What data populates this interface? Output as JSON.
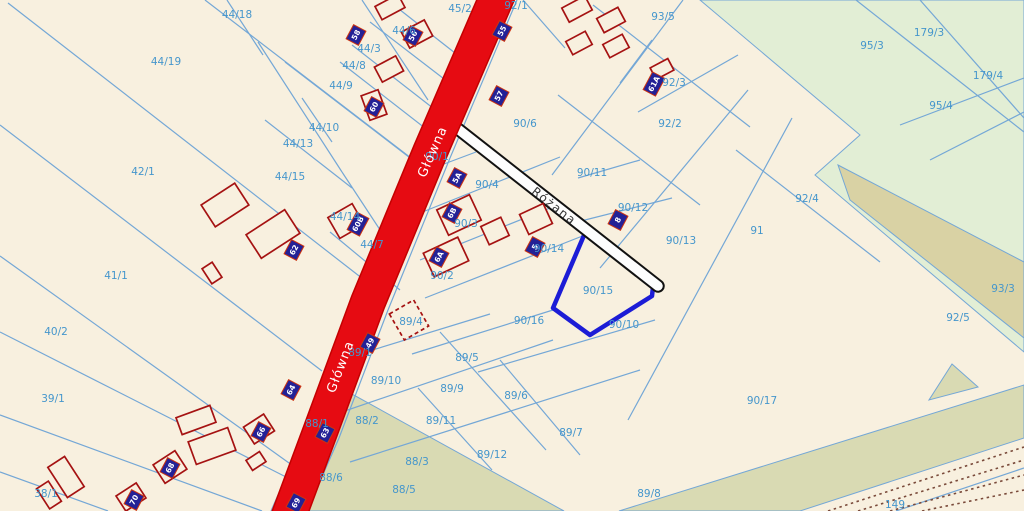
{
  "map": {
    "width": 1024,
    "height": 511,
    "colors": {
      "background": "#f8f0df",
      "boundary_line": "#74a7d6",
      "parcel_label": "#4596cc",
      "road_main_fill": "#e60b12",
      "road_main_casing": "#c40000",
      "road_side_casing": "#111111",
      "road_side_fill": "#fdfdfd",
      "building_outline": "#a51212",
      "plate_fill": "#232196",
      "plate_border": "#cc3311",
      "plate_text": "#ffffff",
      "green_area": "#e2eed5",
      "khaki_area": "#d9d2a4",
      "olive_area": "#d9dab3",
      "highlight_stroke": "#1c1cd6",
      "railway_dots": "#7a4a3a"
    },
    "areas": [
      {
        "name": "forest-green-large",
        "fill": "#e2eed5",
        "points": [
          [
            700,
            0
          ],
          [
            1024,
            0
          ],
          [
            1024,
            352
          ],
          [
            815,
            175
          ],
          [
            860,
            135
          ]
        ]
      },
      {
        "name": "forest-khaki-band",
        "fill": "#d9d2a4",
        "points": [
          [
            838,
            165
          ],
          [
            1024,
            262
          ],
          [
            1024,
            338
          ],
          [
            850,
            200
          ]
        ]
      },
      {
        "name": "olive-left-block",
        "fill": "#d9dab3",
        "points": [
          [
            341,
            388
          ],
          [
            564,
            511
          ],
          [
            300,
            511
          ],
          [
            317,
            430
          ]
        ]
      },
      {
        "name": "olive-bottom-band",
        "fill": "#d9dab3",
        "points": [
          [
            619,
            511
          ],
          [
            1024,
            385
          ],
          [
            1024,
            438
          ],
          [
            800,
            511
          ]
        ]
      },
      {
        "name": "olive-triangle",
        "fill": "#d9dab3",
        "points": [
          [
            952,
            364
          ],
          [
            978,
            387
          ],
          [
            929,
            400
          ]
        ]
      }
    ],
    "boundary_segments": [
      [
        205,
        0,
        424,
        168
      ],
      [
        8,
        3,
        372,
        286
      ],
      [
        0,
        125,
        322,
        371
      ],
      [
        0,
        256,
        296,
        468
      ],
      [
        0,
        332,
        288,
        478
      ],
      [
        0,
        415,
        262,
        511
      ],
      [
        0,
        472,
        108,
        511
      ],
      [
        227,
        0,
        263,
        55
      ],
      [
        258,
        42,
        342,
        172
      ],
      [
        302,
        98,
        332,
        142
      ],
      [
        265,
        120,
        352,
        188
      ],
      [
        285,
        62,
        418,
        164
      ],
      [
        342,
        172,
        388,
        242
      ],
      [
        330,
        232,
        400,
        290
      ],
      [
        362,
        0,
        428,
        100
      ],
      [
        390,
        2,
        455,
        53
      ],
      [
        370,
        22,
        448,
        82
      ],
      [
        352,
        45,
        438,
        112
      ],
      [
        340,
        62,
        430,
        132
      ],
      [
        523,
        0,
        565,
        48
      ],
      [
        593,
        5,
        750,
        127
      ],
      [
        683,
        0,
        552,
        175
      ],
      [
        620,
        83,
        652,
        40
      ],
      [
        638,
        112,
        738,
        55
      ],
      [
        558,
        95,
        700,
        205
      ],
      [
        428,
        170,
        476,
        152
      ],
      [
        420,
        213,
        560,
        157
      ],
      [
        420,
        260,
        560,
        204
      ],
      [
        425,
        298,
        585,
        235
      ],
      [
        412,
        354,
        553,
        310
      ],
      [
        578,
        178,
        640,
        160
      ],
      [
        577,
        222,
        672,
        198
      ],
      [
        748,
        90,
        600,
        268
      ],
      [
        792,
        118,
        628,
        420
      ],
      [
        736,
        150,
        880,
        262
      ],
      [
        478,
        372,
        655,
        320
      ],
      [
        330,
        363,
        490,
        314
      ],
      [
        333,
        415,
        553,
        340
      ],
      [
        350,
        462,
        640,
        370
      ],
      [
        440,
        332,
        546,
        450
      ],
      [
        500,
        360,
        580,
        455
      ],
      [
        418,
        388,
        492,
        470
      ],
      [
        856,
        0,
        1024,
        132
      ],
      [
        920,
        0,
        1024,
        118
      ],
      [
        900,
        125,
        1024,
        78
      ],
      [
        930,
        160,
        1024,
        112
      ],
      [
        896,
        511,
        1024,
        468
      ],
      [
        481,
        0,
        415,
        158
      ],
      [
        415,
        158,
        352,
        310
      ],
      [
        352,
        310,
        303,
        438
      ],
      [
        303,
        438,
        271,
        511
      ],
      [
        517,
        0,
        450,
        158
      ],
      [
        450,
        158,
        388,
        310
      ],
      [
        388,
        310,
        339,
        438
      ],
      [
        339,
        438,
        307,
        511
      ]
    ],
    "railway": {
      "label": "149",
      "dotted_lines": [
        [
          828,
          511,
          1024,
          447
        ],
        [
          858,
          511,
          1024,
          460
        ],
        [
          890,
          511,
          1024,
          475
        ],
        [
          922,
          511,
          1024,
          490
        ]
      ]
    },
    "roads": {
      "glowna": {
        "name": "Główna",
        "centerline": [
          [
            499,
            -8
          ],
          [
            430,
            152
          ],
          [
            368,
            302
          ],
          [
            320,
            432
          ],
          [
            288,
            518
          ]
        ],
        "width": 33,
        "labels": [
          {
            "x": 433,
            "y": 152,
            "rot": -66
          },
          {
            "x": 341,
            "y": 367,
            "rot": -69
          }
        ]
      },
      "rozana": {
        "name": "Różana",
        "centerline": [
          [
            449,
            122
          ],
          [
            658,
            286
          ]
        ],
        "width": 9.5,
        "labels": [
          {
            "x": 554,
            "y": 206,
            "rot": 38
          }
        ]
      }
    },
    "highlighted_parcel": {
      "id": "90/15",
      "points": [
        [
          585,
          233
        ],
        [
          653,
          287
        ],
        [
          652,
          296
        ],
        [
          590,
          335
        ],
        [
          553,
          308
        ]
      ]
    },
    "buildings": [
      {
        "cx": 390,
        "cy": 7,
        "w": 26,
        "h": 15,
        "rot": -28
      },
      {
        "cx": 577,
        "cy": 9,
        "w": 26,
        "h": 16,
        "rot": -28
      },
      {
        "cx": 611,
        "cy": 20,
        "w": 24,
        "h": 16,
        "rot": -28
      },
      {
        "cx": 579,
        "cy": 43,
        "w": 22,
        "h": 15,
        "rot": -28
      },
      {
        "cx": 616,
        "cy": 46,
        "w": 22,
        "h": 15,
        "rot": -28
      },
      {
        "cx": 662,
        "cy": 69,
        "w": 20,
        "h": 13,
        "rot": -28
      },
      {
        "cx": 417,
        "cy": 34,
        "w": 26,
        "h": 18,
        "rot": -28
      },
      {
        "cx": 389,
        "cy": 69,
        "w": 24,
        "h": 17,
        "rot": -28
      },
      {
        "cx": 374,
        "cy": 105,
        "w": 18,
        "h": 26,
        "rot": -20
      },
      {
        "cx": 225,
        "cy": 205,
        "w": 40,
        "h": 26,
        "rot": -33
      },
      {
        "cx": 273,
        "cy": 234,
        "w": 46,
        "h": 28,
        "rot": -33
      },
      {
        "cx": 212,
        "cy": 273,
        "w": 12,
        "h": 18,
        "rot": -33
      },
      {
        "cx": 346,
        "cy": 221,
        "w": 28,
        "h": 24,
        "rot": -30
      },
      {
        "cx": 459,
        "cy": 215,
        "w": 36,
        "h": 28,
        "rot": -25
      },
      {
        "cx": 446,
        "cy": 257,
        "w": 38,
        "h": 26,
        "rot": -25
      },
      {
        "cx": 495,
        "cy": 231,
        "w": 22,
        "h": 20,
        "rot": -25
      },
      {
        "cx": 536,
        "cy": 219,
        "w": 26,
        "h": 22,
        "rot": -25
      },
      {
        "cx": 196,
        "cy": 420,
        "w": 36,
        "h": 18,
        "rot": -20
      },
      {
        "cx": 212,
        "cy": 446,
        "w": 42,
        "h": 24,
        "rot": -20
      },
      {
        "cx": 259,
        "cy": 429,
        "w": 24,
        "h": 20,
        "rot": -33
      },
      {
        "cx": 256,
        "cy": 461,
        "w": 16,
        "h": 12,
        "rot": -33
      },
      {
        "cx": 170,
        "cy": 467,
        "w": 26,
        "h": 22,
        "rot": -33
      },
      {
        "cx": 131,
        "cy": 497,
        "w": 24,
        "h": 18,
        "rot": -33
      },
      {
        "cx": 66,
        "cy": 477,
        "w": 20,
        "h": 36,
        "rot": -33
      },
      {
        "cx": 49,
        "cy": 495,
        "w": 14,
        "h": 24,
        "rot": -33
      },
      {
        "cx": 409,
        "cy": 320,
        "w": 28,
        "h": 30,
        "rot": -30,
        "dashed": true
      }
    ],
    "address_plates": [
      {
        "x": 356,
        "y": 35,
        "num": "58",
        "rot": -62
      },
      {
        "x": 413,
        "y": 36,
        "num": "56",
        "rot": -62
      },
      {
        "x": 502,
        "y": 31,
        "num": "55",
        "rot": -62
      },
      {
        "x": 374,
        "y": 107,
        "num": "60",
        "rot": -62
      },
      {
        "x": 499,
        "y": 96,
        "num": "57",
        "rot": -62
      },
      {
        "x": 654,
        "y": 84,
        "num": "61A",
        "rot": -62
      },
      {
        "x": 457,
        "y": 178,
        "num": "5A",
        "rot": -62
      },
      {
        "x": 358,
        "y": 224,
        "num": "60B",
        "rot": -62
      },
      {
        "x": 294,
        "y": 250,
        "num": "62",
        "rot": -62
      },
      {
        "x": 452,
        "y": 213,
        "num": "6B",
        "rot": -62
      },
      {
        "x": 439,
        "y": 257,
        "num": "6A",
        "rot": -62
      },
      {
        "x": 535,
        "y": 247,
        "num": "5",
        "rot": -62
      },
      {
        "x": 618,
        "y": 220,
        "num": "8",
        "rot": -62
      },
      {
        "x": 291,
        "y": 390,
        "num": "64",
        "rot": -62
      },
      {
        "x": 325,
        "y": 433,
        "num": "63",
        "rot": -62
      },
      {
        "x": 261,
        "y": 432,
        "num": "66",
        "rot": -62
      },
      {
        "x": 370,
        "y": 343,
        "num": "49",
        "rot": -62
      },
      {
        "x": 170,
        "y": 468,
        "num": "68",
        "rot": -62
      },
      {
        "x": 134,
        "y": 500,
        "num": "70",
        "rot": -62
      },
      {
        "x": 296,
        "y": 503,
        "num": "69",
        "rot": -62
      }
    ],
    "parcel_labels": [
      {
        "id": "44/18",
        "x": 237,
        "y": 15
      },
      {
        "id": "45/2",
        "x": 460,
        "y": 9
      },
      {
        "id": "92/1",
        "x": 516,
        "y": 6
      },
      {
        "id": "93/5",
        "x": 663,
        "y": 17
      },
      {
        "id": "179/3",
        "x": 929,
        "y": 33
      },
      {
        "id": "44/19",
        "x": 166,
        "y": 62
      },
      {
        "id": "44/6",
        "x": 404,
        "y": 31
      },
      {
        "id": "44/3",
        "x": 369,
        "y": 49
      },
      {
        "id": "95/3",
        "x": 872,
        "y": 46
      },
      {
        "id": "44/8",
        "x": 354,
        "y": 66
      },
      {
        "id": "44/9",
        "x": 341,
        "y": 86
      },
      {
        "id": "92/3",
        "x": 674,
        "y": 83
      },
      {
        "id": "179/4",
        "x": 988,
        "y": 76
      },
      {
        "id": "44/10",
        "x": 324,
        "y": 128
      },
      {
        "id": "92/2",
        "x": 670,
        "y": 124
      },
      {
        "id": "90/6",
        "x": 525,
        "y": 124
      },
      {
        "id": "95/4",
        "x": 941,
        "y": 106
      },
      {
        "id": "44/13",
        "x": 298,
        "y": 144
      },
      {
        "id": "42/1",
        "x": 143,
        "y": 172
      },
      {
        "id": "44/15",
        "x": 290,
        "y": 177
      },
      {
        "id": "90/1",
        "x": 437,
        "y": 157
      },
      {
        "id": "90/4",
        "x": 487,
        "y": 185
      },
      {
        "id": "90/11",
        "x": 592,
        "y": 173
      },
      {
        "id": "92/4",
        "x": 807,
        "y": 199
      },
      {
        "id": "90/12",
        "x": 633,
        "y": 208
      },
      {
        "id": "44/14",
        "x": 345,
        "y": 217
      },
      {
        "id": "91",
        "x": 757,
        "y": 231
      },
      {
        "id": "90/13",
        "x": 681,
        "y": 241
      },
      {
        "id": "44/7",
        "x": 372,
        "y": 245
      },
      {
        "id": "90/3",
        "x": 466,
        "y": 224
      },
      {
        "id": "90/2",
        "x": 442,
        "y": 276
      },
      {
        "id": "90/14",
        "x": 549,
        "y": 249
      },
      {
        "id": "41/1",
        "x": 116,
        "y": 276
      },
      {
        "id": "90/15",
        "x": 598,
        "y": 291
      },
      {
        "id": "93/3",
        "x": 1003,
        "y": 289
      },
      {
        "id": "92/5",
        "x": 958,
        "y": 318
      },
      {
        "id": "90/16",
        "x": 529,
        "y": 321
      },
      {
        "id": "90/10",
        "x": 624,
        "y": 325
      },
      {
        "id": "40/2",
        "x": 56,
        "y": 332
      },
      {
        "id": "89/4",
        "x": 411,
        "y": 322
      },
      {
        "id": "89/1",
        "x": 360,
        "y": 353
      },
      {
        "id": "89/5",
        "x": 467,
        "y": 358
      },
      {
        "id": "39/1",
        "x": 53,
        "y": 399
      },
      {
        "id": "89/10",
        "x": 386,
        "y": 381
      },
      {
        "id": "89/9",
        "x": 452,
        "y": 389
      },
      {
        "id": "89/6",
        "x": 516,
        "y": 396
      },
      {
        "id": "90/17",
        "x": 762,
        "y": 401
      },
      {
        "id": "88/2",
        "x": 367,
        "y": 421
      },
      {
        "id": "88/1",
        "x": 317,
        "y": 424
      },
      {
        "id": "89/11",
        "x": 441,
        "y": 421
      },
      {
        "id": "89/7",
        "x": 571,
        "y": 433
      },
      {
        "id": "88/3",
        "x": 417,
        "y": 462
      },
      {
        "id": "89/12",
        "x": 492,
        "y": 455
      },
      {
        "id": "88/6",
        "x": 331,
        "y": 478
      },
      {
        "id": "88/5",
        "x": 404,
        "y": 490
      },
      {
        "id": "38/1",
        "x": 46,
        "y": 494
      },
      {
        "id": "89/8",
        "x": 649,
        "y": 494
      },
      {
        "id": "149",
        "x": 895,
        "y": 505
      }
    ]
  }
}
